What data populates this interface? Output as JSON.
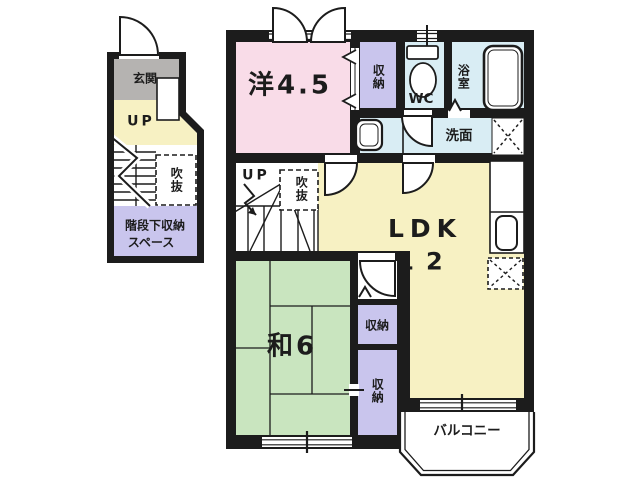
{
  "floor_plan": {
    "annex": {
      "entrance": "玄関",
      "up": "UP",
      "void": "吹抜",
      "under_stair_storage_line1": "階段下収納",
      "under_stair_storage_line2": "スペース"
    },
    "main": {
      "western_room": "洋4.5",
      "western_closet": "収納",
      "toilet": "WC",
      "bathroom": "浴室",
      "washroom": "洗面",
      "ldk": "LDK",
      "ldk_size": "12",
      "stair_up": "UP",
      "stair_void": "吹抜",
      "japanese_room": "和6",
      "closet_upper": "収納",
      "closet_lower": "収納",
      "balcony": "バルコニー"
    },
    "fixtures": [
      "toilet-icon",
      "bathtub-icon",
      "washbasin-icon",
      "kitchen-sink-icon",
      "refrigerator-space-icon",
      "washer-pan-icon",
      "door-arc-icon",
      "stairs-icon"
    ],
    "colors": {
      "wall": "#1c1c1c",
      "western_room": "#f9dce8",
      "ldk": "#f7f1c3",
      "japanese_room": "#c9e5bf",
      "closet": "#c9c5ed",
      "wet_area": "#d9edf4",
      "entrance_hall": "#b5b3b1",
      "background": "#ffffff"
    }
  }
}
